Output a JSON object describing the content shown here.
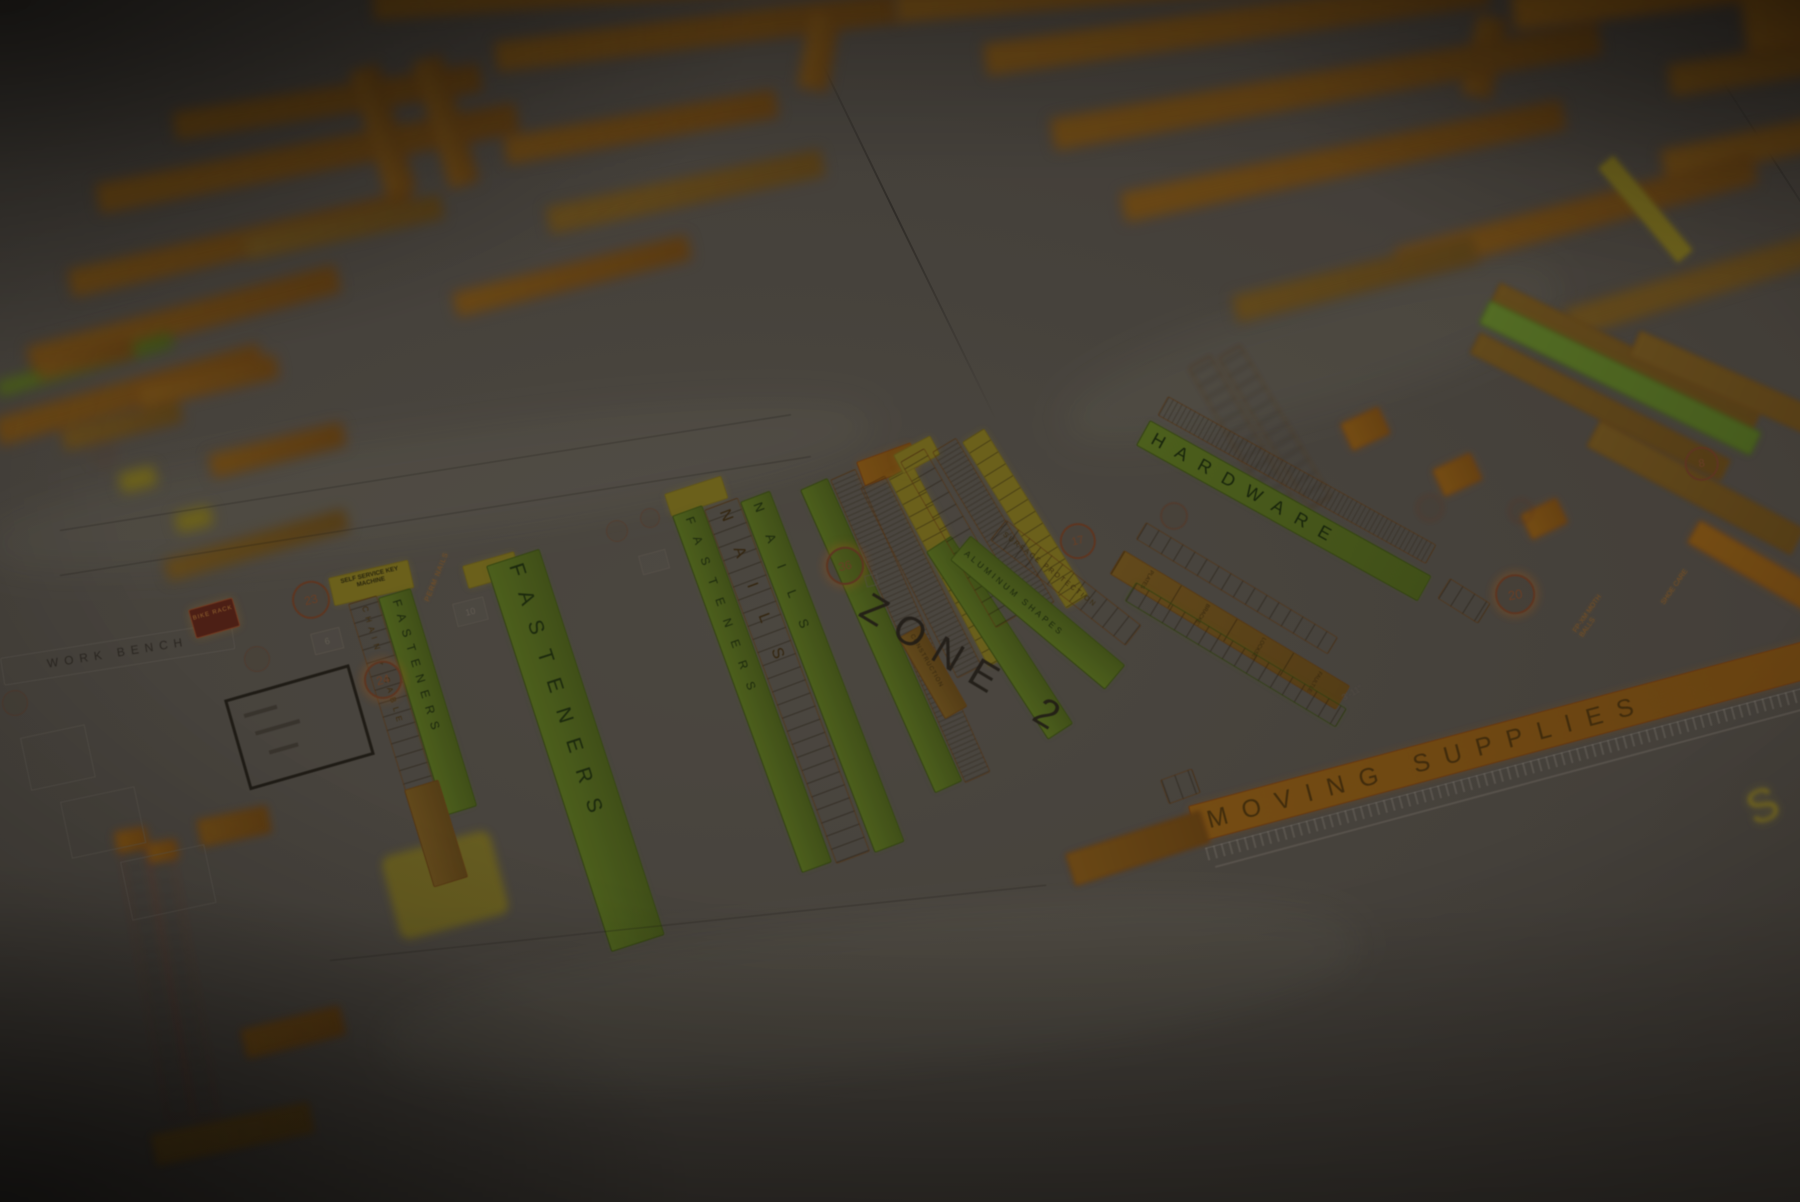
{
  "zone": {
    "label": "ZONE 2"
  },
  "aisles": {
    "fasteners_a": "FASTENERS",
    "fasteners_b": "FASTENERS",
    "fasteners_c": "FASTENERS",
    "nails_a": "NAILS",
    "nails_b": "NAILS",
    "chain_cable": "CHAIN + CABLE",
    "construction": "CONSTRUCTION",
    "aluminum_shapes": "ALUMINUM SHAPES",
    "surface_protection": "SURFACE PROTECTION",
    "hardware": "HARDWARE",
    "moving_supplies": "MOVING SUPPLIES"
  },
  "fixtures": {
    "work_bench": "WORK BENCH",
    "key_machine": "SELF SERVICE KEY MACHINE",
    "bike_rack": "BIKE RACK"
  },
  "shelf_tags": {
    "perm_nails": "PERM NAILS",
    "plates": "PLATES",
    "brackets": "BRACKETS",
    "locksets": "LOCKSETS",
    "faultless": "FAULTLESS",
    "moth_balls": "FP-XM MOTH BALLS",
    "shoe_care": "SHOE CARE",
    "dimension": "3'-11\""
  },
  "markers": {
    "c23": "23",
    "c24": "24",
    "c36": "36",
    "c17": "17",
    "c20": "20",
    "c8": "8",
    "s6": "6",
    "s10": "10"
  },
  "corner_glyph": "S",
  "colors": {
    "paper": "#534e48",
    "highlight_orange": "#7d5418",
    "highlight_green": "#5a7021",
    "highlight_yellow": "#7f7220",
    "ink": "#2b2723",
    "marker_red": "#6f3f26"
  }
}
